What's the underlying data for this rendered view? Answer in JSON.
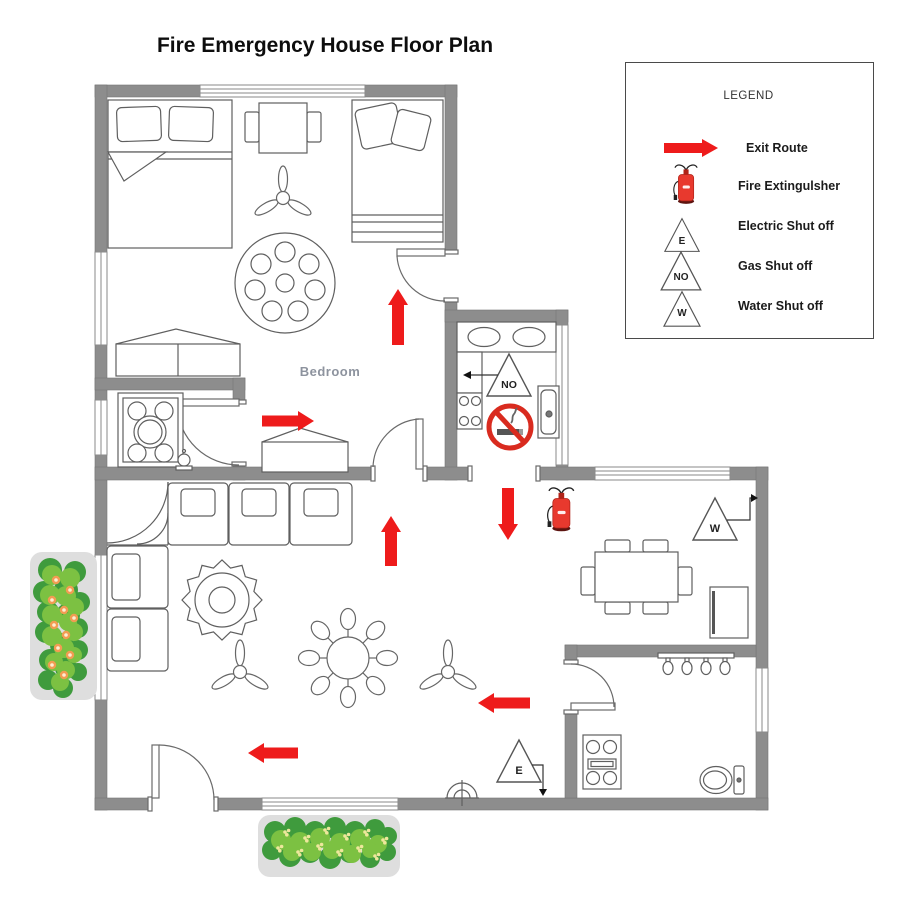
{
  "title": "Fire Emergency House Floor Plan",
  "legend": {
    "title": "LEGEND",
    "items": [
      {
        "label": "Exit Route"
      },
      {
        "label": "Fire Extingulsher"
      },
      {
        "symbol": "E",
        "label": "Electric Shut off"
      },
      {
        "symbol": "NO",
        "label": "Gas Shut off"
      },
      {
        "symbol": "W",
        "label": "Water Shut off"
      }
    ]
  },
  "plan": {
    "room_labels": {
      "bedroom": "Bedroom"
    },
    "markers": {
      "gas_shutoff_symbol": "NO",
      "water_shutoff_symbol": "W",
      "electric_shutoff_symbol": "E"
    }
  },
  "colors": {
    "wall": "#8d8d8d",
    "arrow_red": "#ee1b1b",
    "extinguisher_red": "#e8392e",
    "no_smoking_red": "#d92b1f",
    "hedge_green_light": "#7cc142",
    "hedge_green_dark": "#3f9b3d",
    "room_label_gray": "#8d939e"
  }
}
